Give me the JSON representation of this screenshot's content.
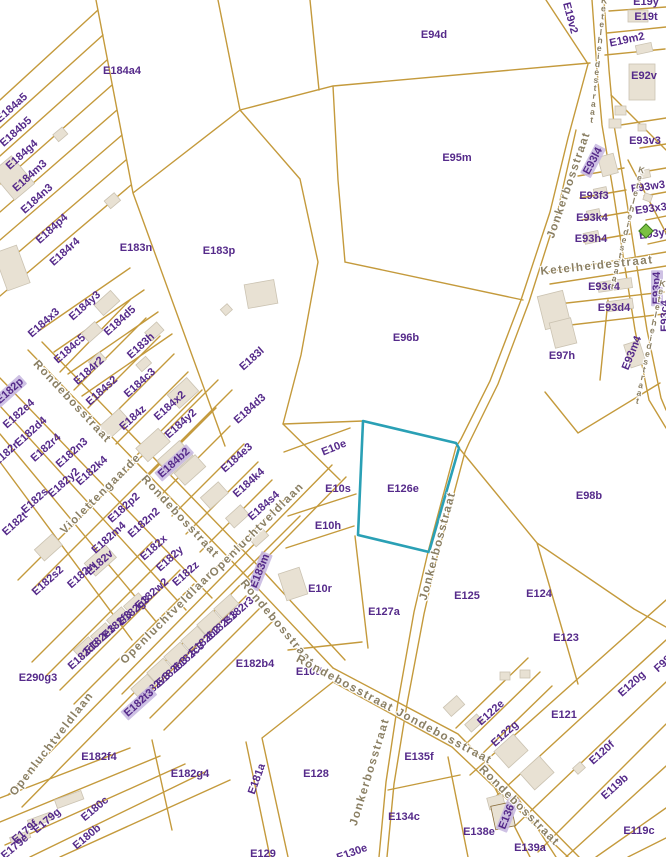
{
  "map": {
    "colors": {
      "background": "#ffffff",
      "parcel_line": "#c49a3c",
      "parcel_label": "#552a8a",
      "street_label": "#8a7f63",
      "building_fill": "#e8e1d3",
      "building_stroke": "#cbc3b2",
      "highlight_outline": "#2aa0b5",
      "highlight_label_bg": "#c6b6df",
      "poi_green": "#7bc143"
    },
    "highlighted_parcel": {
      "label": "E126e",
      "outline_color": "#2aa0b5"
    },
    "parcels": [
      [
        "E184a4",
        122,
        71,
        0,
        0
      ],
      [
        "E94d",
        434,
        35,
        0,
        0
      ],
      [
        "E19v2",
        570,
        18,
        75,
        0
      ],
      [
        "E19y",
        646,
        2,
        0,
        0
      ],
      [
        "E19t",
        646,
        17,
        0,
        0
      ],
      [
        "E19m2",
        627,
        40,
        -12,
        0
      ],
      [
        "E92v",
        644,
        76,
        0,
        0
      ],
      [
        "E93v3",
        645,
        141,
        0,
        0
      ],
      [
        "E95m",
        457,
        158,
        0,
        0
      ],
      [
        "E93l4",
        593,
        161,
        -62,
        1
      ],
      [
        "E93w3",
        648,
        187,
        -8,
        0
      ],
      [
        "E93f3",
        594,
        196,
        0,
        0
      ],
      [
        "E93x3",
        651,
        209,
        -8,
        0
      ],
      [
        "E93k4",
        592,
        218,
        0,
        0
      ],
      [
        "E93y3",
        655,
        234,
        -8,
        0
      ],
      [
        "E93h4",
        591,
        239,
        0,
        0
      ],
      [
        "E93e4",
        604,
        287,
        0,
        0
      ],
      [
        "E93p4",
        657,
        288,
        -90,
        1
      ],
      [
        "E93d4",
        614,
        308,
        0,
        0
      ],
      [
        "E93c4",
        665,
        316,
        -90,
        0
      ],
      [
        "E93m4",
        632,
        353,
        -68,
        0
      ],
      [
        "E97h",
        562,
        356,
        0,
        0
      ],
      [
        "E96b",
        406,
        338,
        0,
        0
      ],
      [
        "E98b",
        589,
        496,
        0,
        0
      ],
      [
        "E183n",
        136,
        248,
        0,
        0
      ],
      [
        "E183p",
        219,
        251,
        0,
        0
      ],
      [
        "E184a5",
        12,
        108,
        -42,
        0
      ],
      [
        "E184b5",
        16,
        132,
        -42,
        0
      ],
      [
        "E184g4",
        22,
        155,
        -42,
        0
      ],
      [
        "E184m3",
        30,
        176,
        -42,
        0
      ],
      [
        "E184n3",
        37,
        199,
        -42,
        0
      ],
      [
        "E184p4",
        52,
        229,
        -42,
        0
      ],
      [
        "E184r4",
        65,
        252,
        -42,
        0
      ],
      [
        "E184x3",
        44,
        323,
        -42,
        0
      ],
      [
        "E184y3",
        85,
        306,
        -42,
        0
      ],
      [
        "E184d5",
        120,
        321,
        -42,
        0
      ],
      [
        "E184c5",
        70,
        349,
        -42,
        0
      ],
      [
        "E183h",
        141,
        346,
        -42,
        0
      ],
      [
        "E184r2",
        89,
        371,
        -42,
        0
      ],
      [
        "E184s2",
        102,
        391,
        -42,
        0
      ],
      [
        "E184c3",
        140,
        383,
        -42,
        0
      ],
      [
        "E183l",
        252,
        359,
        -42,
        0
      ],
      [
        "E184d3",
        250,
        409,
        -42,
        0
      ],
      [
        "E184z",
        133,
        418,
        -42,
        0
      ],
      [
        "E184x2",
        170,
        406,
        -42,
        0
      ],
      [
        "E184y2",
        181,
        424,
        -42,
        0
      ],
      [
        "E182p",
        10,
        391,
        -42,
        1
      ],
      [
        "E182e4",
        19,
        414,
        -42,
        0
      ],
      [
        "E182d4",
        31,
        432,
        -42,
        0
      ],
      [
        "E182r4",
        46,
        448,
        -42,
        0
      ],
      [
        "E182r",
        6,
        454,
        -42,
        0
      ],
      [
        "E182n3",
        72,
        453,
        -42,
        0
      ],
      [
        "E182k4",
        92,
        471,
        -42,
        0
      ],
      [
        "E182y2",
        64,
        483,
        -42,
        0
      ],
      [
        "E182s",
        35,
        501,
        -42,
        0
      ],
      [
        "E182t",
        15,
        524,
        -42,
        0
      ],
      [
        "E184b2",
        174,
        463,
        -42,
        1
      ],
      [
        "E184e3",
        237,
        458,
        -42,
        0
      ],
      [
        "E184k4",
        249,
        483,
        -42,
        0
      ],
      [
        "E184s4",
        264,
        506,
        -42,
        0
      ],
      [
        "E183m",
        260,
        571,
        -68,
        1
      ],
      [
        "E10e",
        334,
        448,
        -22,
        0
      ],
      [
        "E10s",
        338,
        489,
        0,
        0
      ],
      [
        "E126e",
        403,
        489,
        0,
        0
      ],
      [
        "E10h",
        328,
        526,
        0,
        0
      ],
      [
        "E10r",
        320,
        589,
        0,
        0
      ],
      [
        "E10d",
        309,
        672,
        0,
        0
      ],
      [
        "E127a",
        384,
        612,
        0,
        0
      ],
      [
        "E125",
        467,
        596,
        0,
        0
      ],
      [
        "E124",
        539,
        594,
        0,
        0
      ],
      [
        "E123",
        566,
        638,
        0,
        0
      ],
      [
        "E182p2",
        124,
        508,
        -42,
        0
      ],
      [
        "E182n2",
        144,
        523,
        -42,
        0
      ],
      [
        "E182m4",
        109,
        538,
        -42,
        0
      ],
      [
        "E182x",
        154,
        548,
        -42,
        0
      ],
      [
        "E182y",
        170,
        559,
        -42,
        0
      ],
      [
        "E182v",
        100,
        563,
        -42,
        0
      ],
      [
        "E182w",
        82,
        575,
        -42,
        0
      ],
      [
        "E182z",
        186,
        574,
        -42,
        0
      ],
      [
        "E182s2",
        48,
        581,
        -42,
        0
      ],
      [
        "E182w2",
        152,
        594,
        -42,
        0
      ],
      [
        "E182g3",
        134,
        611,
        -42,
        0
      ],
      [
        "E182f3",
        117,
        625,
        -42,
        0
      ],
      [
        "E182e3",
        100,
        640,
        -42,
        0
      ],
      [
        "E182d3",
        84,
        655,
        -42,
        0
      ],
      [
        "E290g3",
        38,
        678,
        0,
        0
      ],
      [
        "E182r3",
        239,
        611,
        -42,
        0
      ],
      [
        "E182s3",
        222,
        626,
        -42,
        0
      ],
      [
        "E182b2",
        205,
        641,
        -42,
        0
      ],
      [
        "E182c3",
        189,
        657,
        -42,
        0
      ],
      [
        "E182b3",
        172,
        672,
        -42,
        0
      ],
      [
        "E182v3",
        155,
        687,
        -42,
        0
      ],
      [
        "E182t3",
        139,
        703,
        -42,
        1
      ],
      [
        "E182b4",
        255,
        664,
        0,
        0
      ],
      [
        "E182f4",
        99,
        757,
        0,
        0
      ],
      [
        "E182g4",
        190,
        774,
        0,
        0
      ],
      [
        "E181a",
        257,
        779,
        -70,
        0
      ],
      [
        "E128",
        316,
        774,
        0,
        0
      ],
      [
        "E180c",
        95,
        809,
        -40,
        0
      ],
      [
        "E179g",
        47,
        821,
        -40,
        0
      ],
      [
        "E179f",
        25,
        832,
        -40,
        0
      ],
      [
        "E180b",
        87,
        837,
        -40,
        0
      ],
      [
        "E179e",
        15,
        847,
        -40,
        0
      ],
      [
        "E129",
        263,
        854,
        0,
        0
      ],
      [
        "E130e",
        352,
        853,
        -20,
        0
      ],
      [
        "E135f",
        419,
        757,
        0,
        0
      ],
      [
        "E134c",
        404,
        817,
        0,
        0
      ],
      [
        "E138e",
        479,
        832,
        0,
        0
      ],
      [
        "E136e",
        508,
        814,
        -68,
        1
      ],
      [
        "E139a",
        530,
        848,
        0,
        0
      ],
      [
        "E122e",
        491,
        713,
        -42,
        0
      ],
      [
        "E122g",
        505,
        734,
        -42,
        0
      ],
      [
        "E121",
        564,
        715,
        0,
        0
      ],
      [
        "E120g",
        632,
        684,
        -42,
        0
      ],
      [
        "F98",
        663,
        664,
        -42,
        0
      ],
      [
        "E120f",
        602,
        753,
        -42,
        0
      ],
      [
        "E119b",
        615,
        787,
        -42,
        0
      ],
      [
        "E119c",
        639,
        831,
        0,
        0
      ]
    ],
    "streets": [
      [
        "Rondebosstraat",
        72,
        402,
        47,
        "linear"
      ],
      [
        "Rondebosstraat",
        180,
        517,
        47,
        "linear"
      ],
      [
        "Rondebosstraat",
        277,
        623,
        50,
        "linear"
      ],
      [
        "Rondebosstraat Jondebosstraat",
        394,
        710,
        28,
        "linear"
      ],
      [
        "Rondebosstraat",
        519,
        806,
        45,
        "linear"
      ],
      [
        "Violettengaarde",
        101,
        494,
        -45,
        "linear"
      ],
      [
        "Openluchtveldlaan",
        168,
        617,
        -45,
        "linear"
      ],
      [
        "Openluchtveldlaan",
        52,
        744,
        -52,
        "linear"
      ],
      [
        "Openluchtveldlaan",
        257,
        530,
        -45,
        "linear"
      ],
      [
        "Jonkerbosstraat",
        569,
        185,
        -71,
        "linear"
      ],
      [
        "Jonkerbosstraat",
        438,
        546,
        -75,
        "linear"
      ],
      [
        "Jonkerbosstraat",
        370,
        772,
        -73,
        "linear"
      ],
      [
        "Ketelheidestraat",
        598,
        60,
        6,
        "stacked"
      ],
      [
        "Ketelheidestraat",
        627,
        228,
        14,
        "stacked"
      ],
      [
        "Ketelheidestraat",
        597,
        266,
        -6,
        "linear"
      ],
      [
        "Ketelheidestraat",
        650,
        342,
        12,
        "stacked"
      ]
    ],
    "icons": [
      [
        "green-diamond-icon",
        646,
        231
      ]
    ]
  }
}
